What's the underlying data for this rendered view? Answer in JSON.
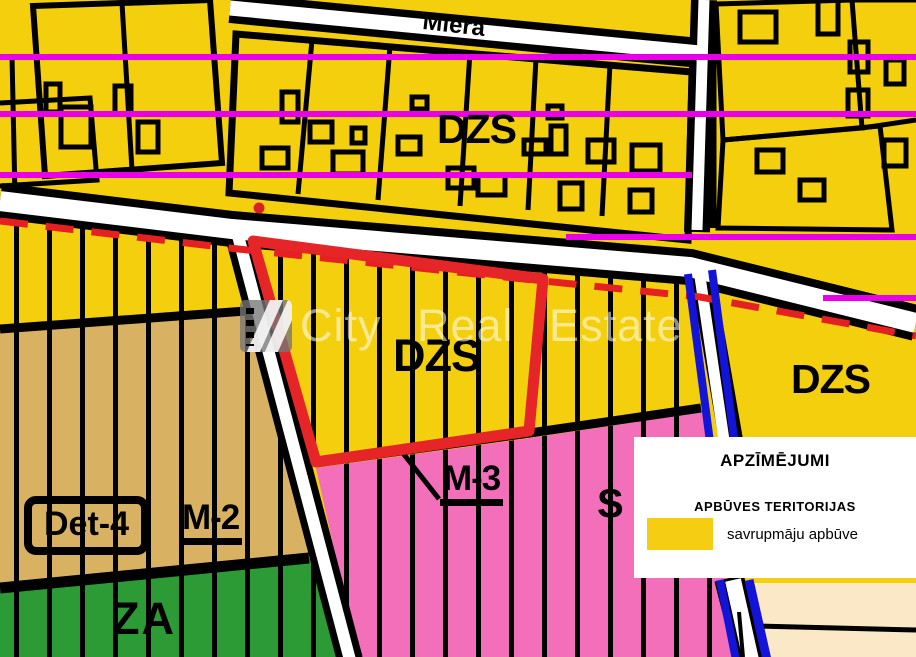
{
  "map": {
    "street_label": "Miera",
    "watermark_text": "City Real Estate",
    "labels": {
      "dzs_top": "DZS",
      "dzs_center": "DZS",
      "dzs_right": "DZS",
      "det_4": "Det-4",
      "m_2": "M-2",
      "m_3": "M-3",
      "s": "S",
      "za": "ZA"
    },
    "colors": {
      "residential_yellow": "#F4CF0D",
      "mixed_tan": "#D8B262",
      "green_area": "#2D9B35",
      "pink_area": "#F36FB9",
      "magenta_line": "#E800E8",
      "highlight_red": "#E52528",
      "blue_line": "#1414D8",
      "beige_area": "#FAE8C6",
      "road_white": "#FFFFFF"
    }
  },
  "legend": {
    "title": "APZĪMĒJUMI",
    "section_title": "APBŪVES TERITORIJAS",
    "items": [
      {
        "swatch_color": "#F5CE14",
        "label": "savrupmāju apbūve"
      }
    ]
  }
}
